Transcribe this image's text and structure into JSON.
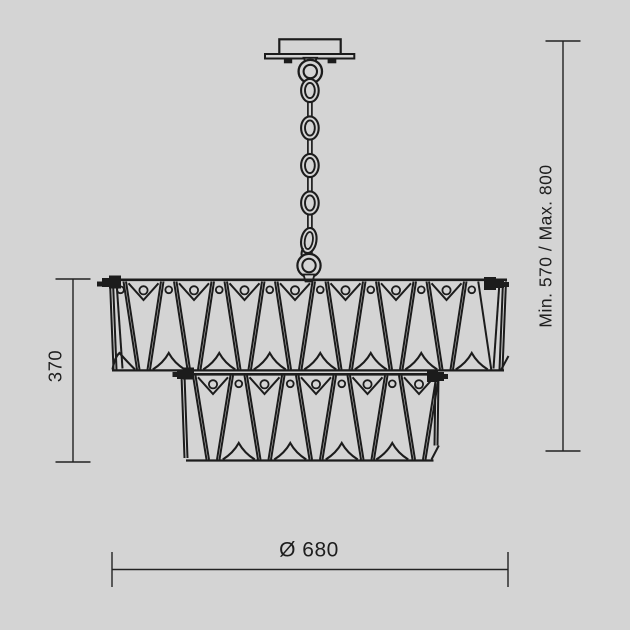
{
  "drawing": {
    "subject": "two-tier-crystal-chandelier-technical-dimension-drawing",
    "background_color": "#d4d4d4",
    "line_color": "#1c1c1c",
    "dimension_color": "#222222"
  },
  "dimensions": {
    "body_height": {
      "label": "370"
    },
    "suspension_height": {
      "label": "Min. 570 / Max. 800"
    },
    "diameter": {
      "label": "Ø 680"
    }
  },
  "figure": {
    "tier1": {
      "large_crystals": 7,
      "spacer_crystals": 7
    },
    "tier2": {
      "large_crystals": 5,
      "spacer_crystals": 4
    },
    "chain_links": 4
  }
}
